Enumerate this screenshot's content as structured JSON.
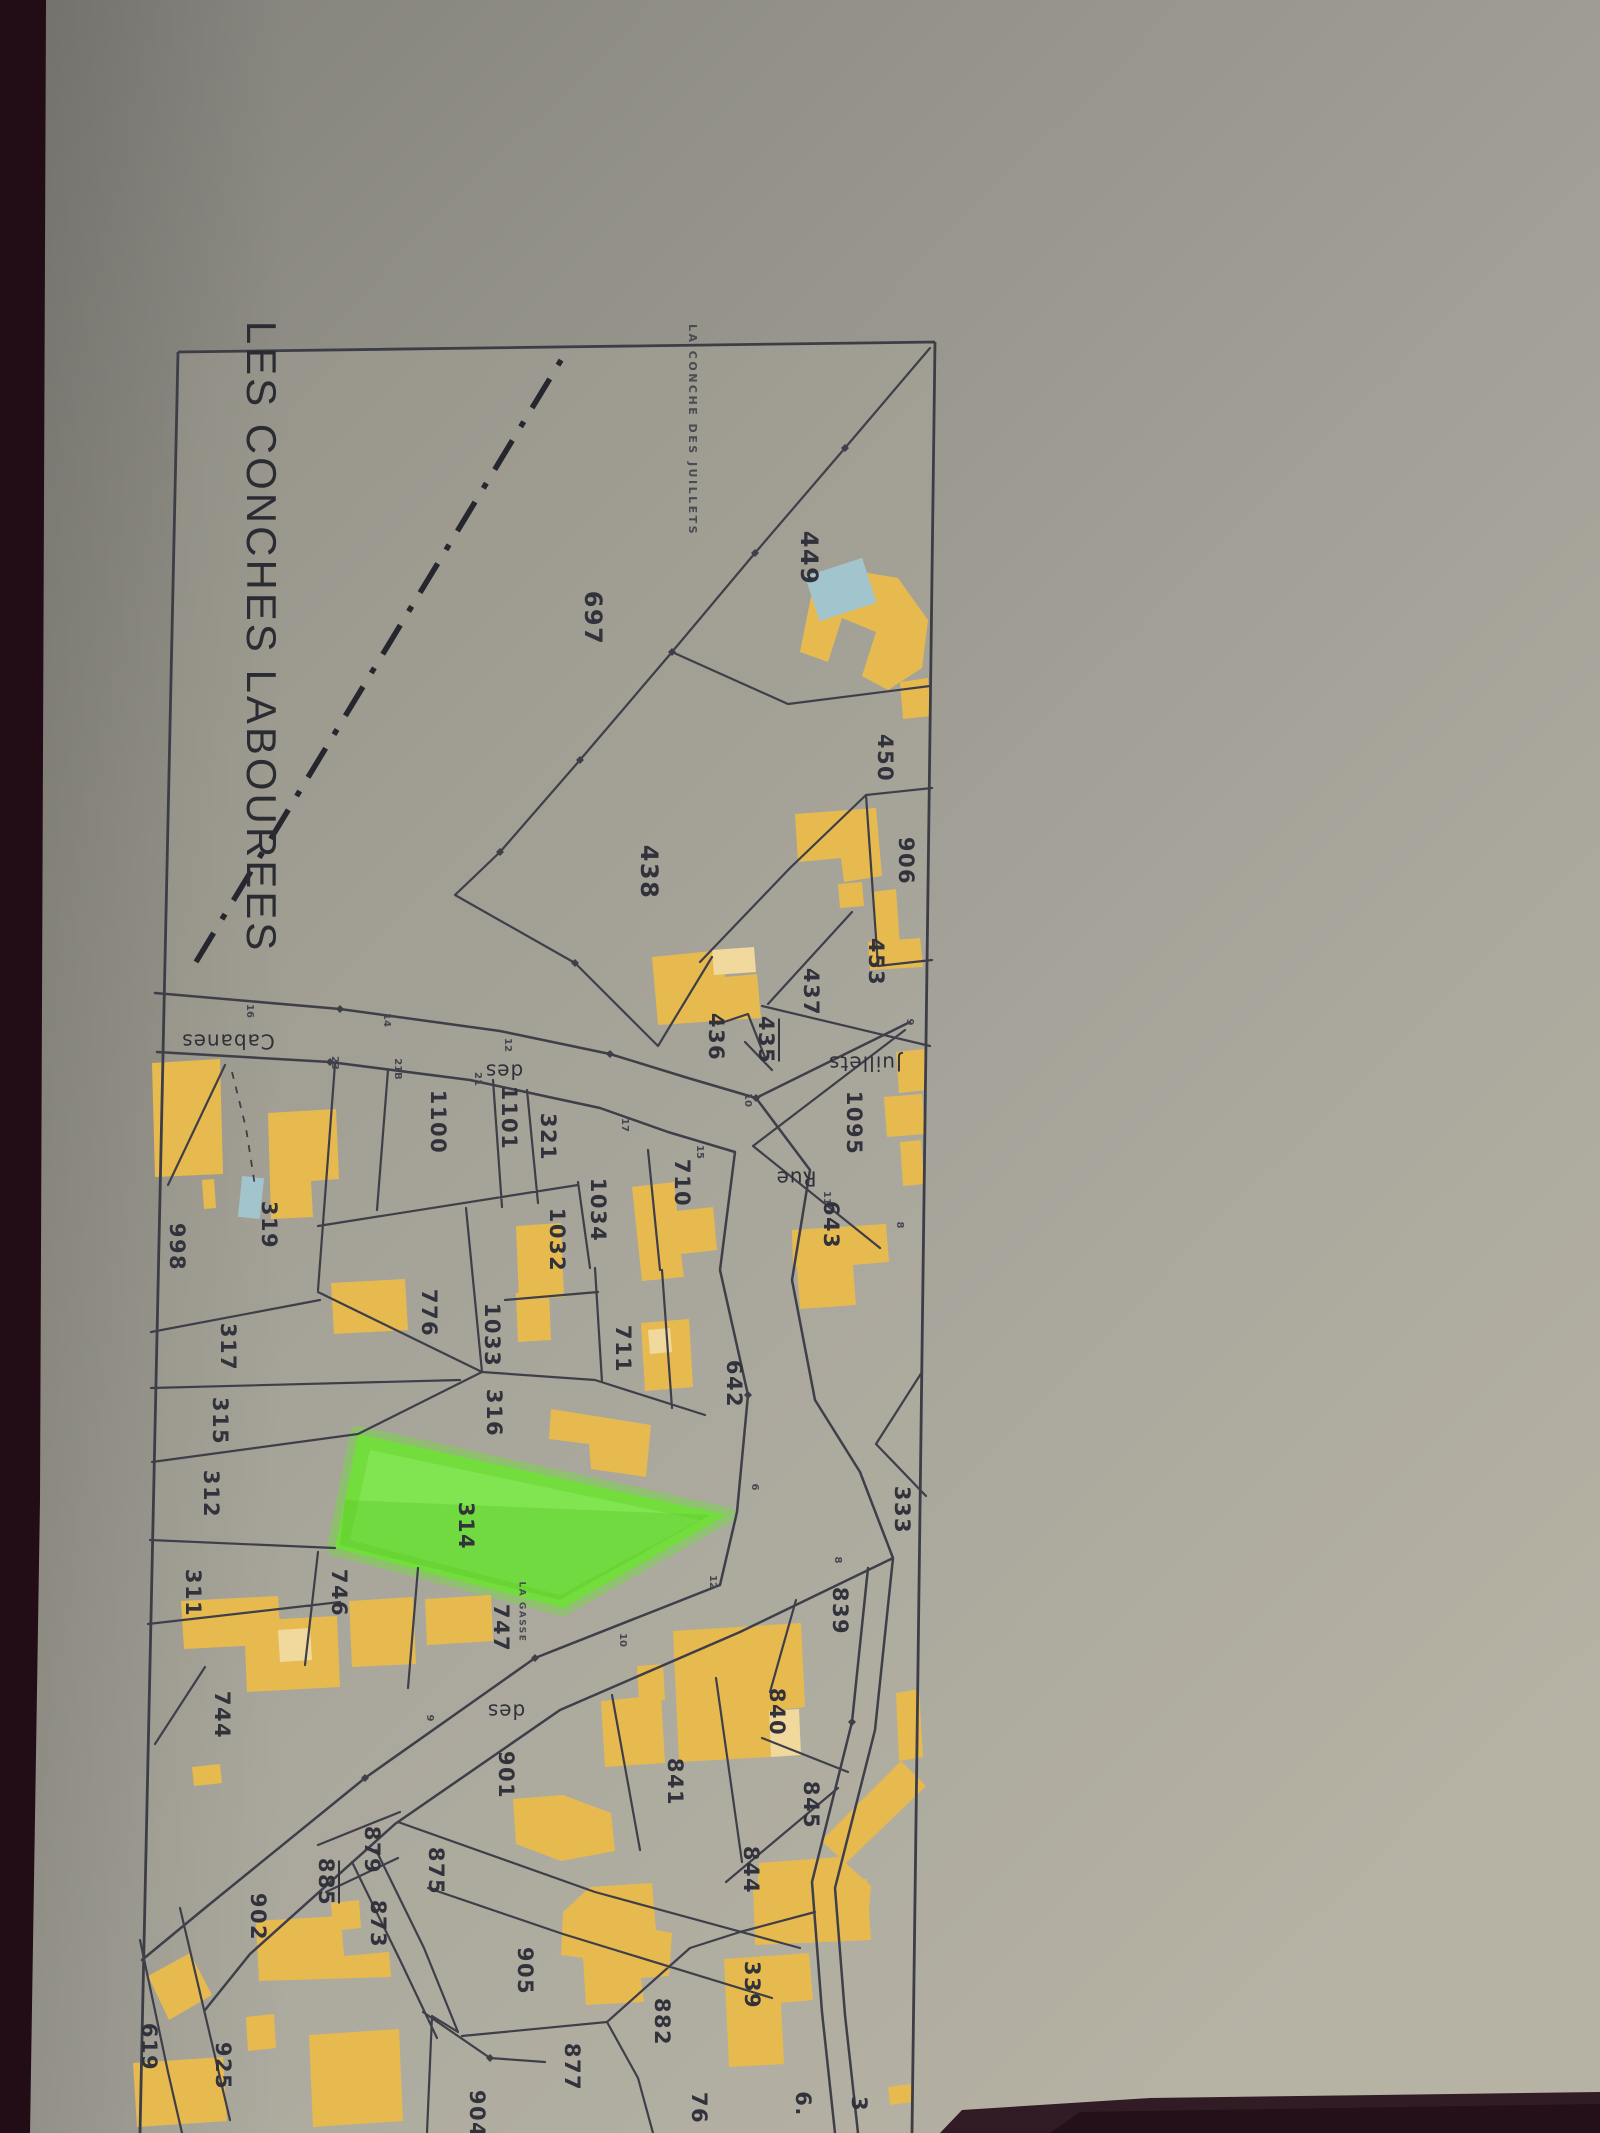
{
  "title": "LES CONCHES LABOUREES",
  "map": {
    "highlighted_parcel": "314",
    "colors": {
      "paper": "#9a988c",
      "desk_edge": "#220c15",
      "line": "#3e3f49",
      "building": "#e7ba50",
      "building_annex": "#f1d89c",
      "pool": "#a2c4cd",
      "highlight_green": "#72dd3c"
    },
    "locality_labels": [
      {
        "t": "LA CONCHE DES JUILLETS",
        "x": 692,
        "y": 430,
        "r": 90
      },
      {
        "t": "LA GASSE",
        "x": 522,
        "y": 1612,
        "r": 90,
        "cls": "sm"
      }
    ],
    "street_labels": [
      {
        "t": "Cabanes",
        "x": 228,
        "y": 1040,
        "r": 180
      },
      {
        "t": "des",
        "x": 504,
        "y": 1070,
        "r": 180
      },
      {
        "t": "Juillets",
        "x": 865,
        "y": 1062,
        "r": 180
      },
      {
        "t": "Rue",
        "x": 796,
        "y": 1177,
        "r": 180
      },
      {
        "t": "des",
        "x": 506,
        "y": 1710,
        "r": 180
      }
    ],
    "parcel_labels": [
      {
        "t": "697",
        "x": 592,
        "y": 618,
        "r": 90,
        "cls": "lg"
      },
      {
        "t": "449",
        "x": 808,
        "y": 558,
        "r": 90,
        "cls": "lg"
      },
      {
        "t": "438",
        "x": 648,
        "y": 872,
        "r": 90,
        "cls": "lg"
      },
      {
        "t": "450",
        "x": 884,
        "y": 758,
        "r": 90
      },
      {
        "t": "906",
        "x": 905,
        "y": 861,
        "r": 90
      },
      {
        "t": "453",
        "x": 875,
        "y": 962,
        "r": 90
      },
      {
        "t": "437",
        "x": 810,
        "y": 992,
        "r": 90
      },
      {
        "t": "436",
        "x": 715,
        "y": 1037,
        "r": 90
      },
      {
        "t": "435",
        "x": 765,
        "y": 1040,
        "r": 90,
        "u": true
      },
      {
        "t": "1095",
        "x": 853,
        "y": 1123,
        "r": 90
      },
      {
        "t": "643",
        "x": 830,
        "y": 1225,
        "r": 90
      },
      {
        "t": "710",
        "x": 681,
        "y": 1183,
        "r": 90
      },
      {
        "t": "1034",
        "x": 597,
        "y": 1210,
        "r": 90
      },
      {
        "t": "1032",
        "x": 556,
        "y": 1240,
        "r": 90
      },
      {
        "t": "1100",
        "x": 437,
        "y": 1122,
        "r": 90
      },
      {
        "t": "1101",
        "x": 508,
        "y": 1118,
        "r": 90
      },
      {
        "t": "321",
        "x": 547,
        "y": 1137,
        "r": 90
      },
      {
        "t": "319",
        "x": 268,
        "y": 1225,
        "r": 90
      },
      {
        "t": "998",
        "x": 176,
        "y": 1247,
        "r": 90
      },
      {
        "t": "776",
        "x": 428,
        "y": 1313,
        "r": 90
      },
      {
        "t": "1033",
        "x": 491,
        "y": 1335,
        "r": 90
      },
      {
        "t": "711",
        "x": 622,
        "y": 1349,
        "r": 90
      },
      {
        "t": "642",
        "x": 733,
        "y": 1384,
        "r": 90
      },
      {
        "t": "317",
        "x": 227,
        "y": 1347,
        "r": 90
      },
      {
        "t": "316",
        "x": 493,
        "y": 1413,
        "r": 90
      },
      {
        "t": "315",
        "x": 219,
        "y": 1421,
        "r": 90
      },
      {
        "t": "312",
        "x": 210,
        "y": 1494,
        "r": 90
      },
      {
        "t": "314",
        "x": 465,
        "y": 1526,
        "r": 90
      },
      {
        "t": "311",
        "x": 192,
        "y": 1593,
        "r": 90
      },
      {
        "t": "746",
        "x": 338,
        "y": 1593,
        "r": 90
      },
      {
        "t": "747",
        "x": 500,
        "y": 1628,
        "r": 90
      },
      {
        "t": "744",
        "x": 221,
        "y": 1715,
        "r": 90
      },
      {
        "t": "901",
        "x": 505,
        "y": 1775,
        "r": 90
      },
      {
        "t": "875",
        "x": 435,
        "y": 1871,
        "r": 90
      },
      {
        "t": "879",
        "x": 371,
        "y": 1850,
        "r": 90
      },
      {
        "t": "885",
        "x": 325,
        "y": 1882,
        "r": 90,
        "u": true
      },
      {
        "t": "873",
        "x": 377,
        "y": 1924,
        "r": 90
      },
      {
        "t": "902",
        "x": 257,
        "y": 1917,
        "r": 90
      },
      {
        "t": "905",
        "x": 524,
        "y": 1971,
        "r": 90
      },
      {
        "t": "925",
        "x": 222,
        "y": 2066,
        "r": 90
      },
      {
        "t": "619",
        "x": 148,
        "y": 2047,
        "r": 90
      },
      {
        "t": "839",
        "x": 839,
        "y": 1611,
        "r": 90
      },
      {
        "t": "840",
        "x": 776,
        "y": 1712,
        "r": 90
      },
      {
        "t": "841",
        "x": 674,
        "y": 1782,
        "r": 90
      },
      {
        "t": "845",
        "x": 810,
        "y": 1805,
        "r": 90
      },
      {
        "t": "844",
        "x": 750,
        "y": 1870,
        "r": 90
      },
      {
        "t": "333",
        "x": 901,
        "y": 1510,
        "r": 90
      },
      {
        "t": "882",
        "x": 661,
        "y": 2022,
        "r": 90
      },
      {
        "t": "877",
        "x": 571,
        "y": 2067,
        "r": 90
      },
      {
        "t": "339",
        "x": 751,
        "y": 1985,
        "r": 90
      },
      {
        "t": "904",
        "x": 476,
        "y": 2114,
        "r": 90
      },
      {
        "t": "76",
        "x": 698,
        "y": 2108,
        "r": 90
      },
      {
        "t": "6.",
        "x": 802,
        "y": 2104,
        "r": 90
      },
      {
        "t": "3",
        "x": 858,
        "y": 2104,
        "r": 90
      }
    ],
    "road_numbers": [
      {
        "t": "16",
        "x": 250,
        "y": 1011,
        "r": 90
      },
      {
        "t": "14",
        "x": 387,
        "y": 1020,
        "r": 90
      },
      {
        "t": "12",
        "x": 508,
        "y": 1045,
        "r": 90
      },
      {
        "t": "23",
        "x": 335,
        "y": 1063,
        "r": 90
      },
      {
        "t": "21B",
        "x": 398,
        "y": 1069,
        "r": 90
      },
      {
        "t": "21",
        "x": 478,
        "y": 1079,
        "r": 90
      },
      {
        "t": "9",
        "x": 910,
        "y": 1022,
        "r": 90
      },
      {
        "t": "10",
        "x": 748,
        "y": 1100,
        "r": 90
      },
      {
        "t": "17",
        "x": 625,
        "y": 1125,
        "r": 90
      },
      {
        "t": "15",
        "x": 700,
        "y": 1152,
        "r": 90
      },
      {
        "t": "11",
        "x": 827,
        "y": 1198,
        "r": 90
      },
      {
        "t": "8",
        "x": 900,
        "y": 1225,
        "r": 90
      },
      {
        "t": "6",
        "x": 755,
        "y": 1487,
        "r": 90
      },
      {
        "t": "8",
        "x": 838,
        "y": 1560,
        "r": 90
      },
      {
        "t": "12",
        "x": 713,
        "y": 1582,
        "r": 90
      },
      {
        "t": "10",
        "x": 623,
        "y": 1640,
        "r": 90
      },
      {
        "t": "9",
        "x": 430,
        "y": 1718,
        "r": 90
      }
    ]
  }
}
